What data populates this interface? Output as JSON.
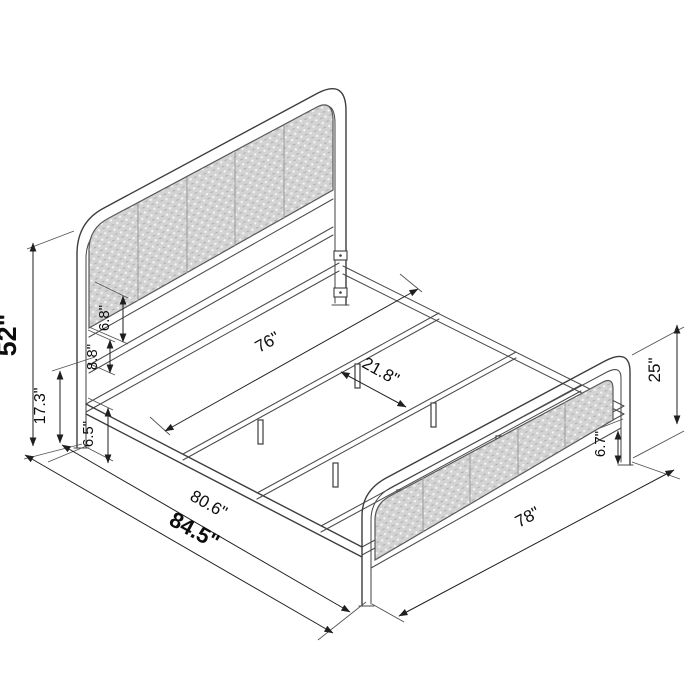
{
  "diagram": {
    "subject": "metal platform bed frame with woven cane headboard and footboard, isometric dimension drawing",
    "dimensions": {
      "d52": {
        "label": "52\"",
        "value": 52,
        "unit": "in",
        "meaning": "overall headboard height"
      },
      "d17_3": {
        "label": "17.3\"",
        "value": 17.3,
        "unit": "in",
        "meaning": "headboard leg / lower section height"
      },
      "d6_5": {
        "label": "6.5\"",
        "value": 6.5,
        "unit": "in",
        "meaning": "under-frame clearance at headboard"
      },
      "d8_8": {
        "label": "8.8\"",
        "value": 8.8,
        "unit": "in",
        "meaning": "gap between headboard crossbars"
      },
      "d6_8": {
        "label": "6.8\"",
        "value": 6.8,
        "unit": "in",
        "meaning": "gap below headboard cane panel"
      },
      "d76": {
        "label": "76\"",
        "value": 76,
        "unit": "in",
        "meaning": "inner frame width"
      },
      "d21_8": {
        "label": "21.8\"",
        "value": 21.8,
        "unit": "in",
        "meaning": "spacing between support crossbars"
      },
      "d80_6": {
        "label": "80.6\"",
        "value": 80.6,
        "unit": "in",
        "meaning": "frame length"
      },
      "d84_5": {
        "label": "84.5\"",
        "value": 84.5,
        "unit": "in",
        "meaning": "overall length"
      },
      "d78": {
        "label": "78\"",
        "value": 78,
        "unit": "in",
        "meaning": "footboard width"
      },
      "d25": {
        "label": "25\"",
        "value": 25,
        "unit": "in",
        "meaning": "footboard height"
      },
      "d6_7": {
        "label": "6.7\"",
        "value": 6.7,
        "unit": "in",
        "meaning": "footboard bottom rail clearance"
      }
    }
  }
}
